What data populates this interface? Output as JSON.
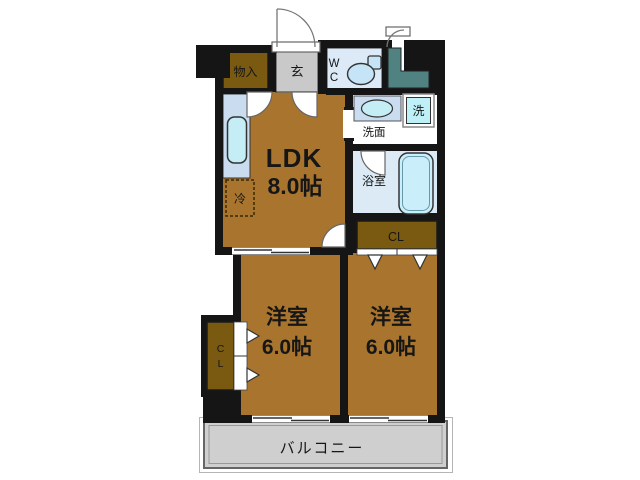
{
  "floor_plan": {
    "rooms": {
      "ldk": {
        "name": "LDK",
        "size": "8.0帖"
      },
      "bedroom_left": {
        "name": "洋室",
        "size": "6.0帖"
      },
      "bedroom_right": {
        "name": "洋室",
        "size": "6.0帖"
      },
      "entrance": {
        "label": "玄"
      },
      "entrance_storage": {
        "label": "物入"
      },
      "wc": {
        "line1": "W",
        "line2": "C"
      },
      "washroom": {
        "label": "洗面"
      },
      "washer": {
        "label": "洗"
      },
      "bathroom": {
        "label": "浴室"
      },
      "refrigerator": {
        "label": "冷"
      },
      "closet_main": {
        "label": "CL"
      },
      "closet_left": {
        "line1": "C",
        "line2": "L"
      },
      "balcony": {
        "label": "バルコニー"
      }
    },
    "colors": {
      "wall_black": "#151515",
      "room_brown": "#A9752E",
      "closet_brown": "#7A5A10",
      "entrance_gray": "#C9C9C9",
      "balcony_gray": "#CFCFCF",
      "fixture_blue": "#C9DCF0",
      "water_blue": "#C5EDF6",
      "wc_blue": "#DCEAF8",
      "bath_blue": "#DCEAF6",
      "tub_blue": "#CBEFFA",
      "utility_teal": "#4F8281"
    }
  }
}
